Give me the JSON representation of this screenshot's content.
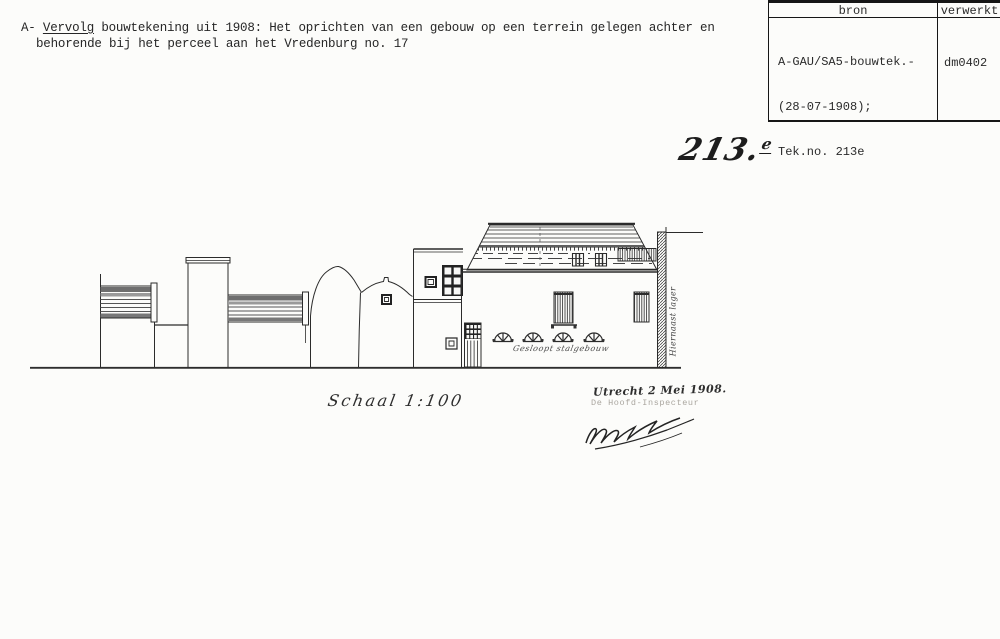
{
  "colors": {
    "paper": "#fcfcfa",
    "ink": "#232323",
    "faint_type": "#aaa69f"
  },
  "header_note": {
    "prefix": "A- ",
    "underlined_word": "Vervolg",
    "line1_rest": " bouwtekening uit 1908: Het oprichten van een gebouw op een terrein gelegen achter en",
    "line2": "behorende bij het perceel aan het Vredenburg no. 17"
  },
  "ref_table": {
    "headers": [
      "bron",
      "verwerkt"
    ],
    "bron_lines": [
      "A-GAU/SA5-bouwtek.-",
      "(28-07-1908);",
      "Tek.no. 213e"
    ],
    "verwerkt_value": "dm0402"
  },
  "drawing": {
    "number_main": "213.",
    "number_suffix": "e",
    "scale_label": "Schaal 1:100",
    "date_label": "Utrecht 2 Mei 1908.",
    "signer_label": "De Hoofd-Inspecteur",
    "facade_annotation": "Gesloopt stalgebouw",
    "boundary_annotation": "Hiernaast lager"
  }
}
